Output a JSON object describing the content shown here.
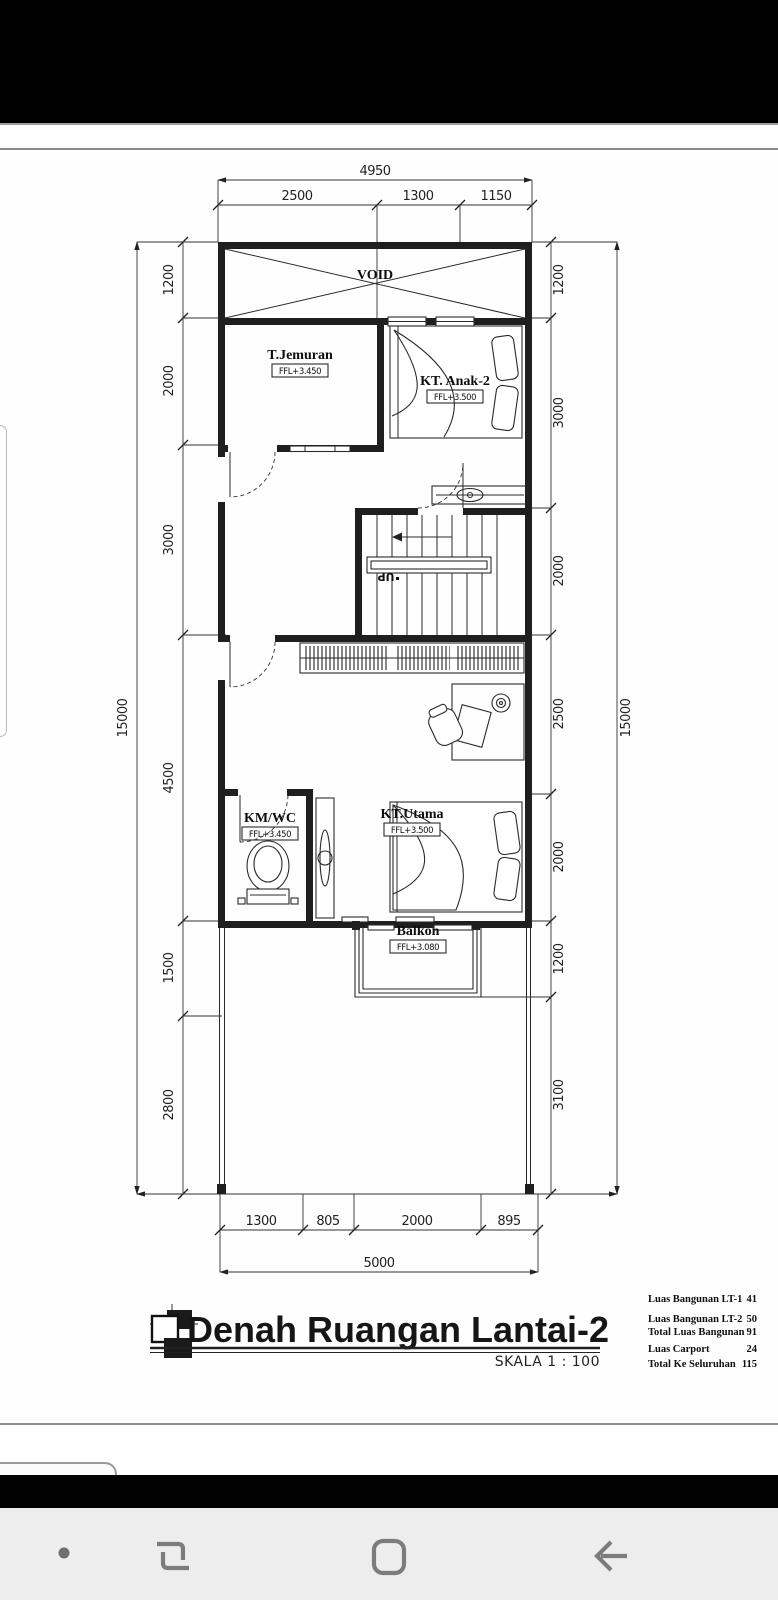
{
  "plan": {
    "title": "Denah Ruangan Lantai-2",
    "scale": "SKALA 1 : 100",
    "rooms": {
      "void": "VOID",
      "jemuran": {
        "name": "T.Jemuran",
        "ffl": "FFL+3.450"
      },
      "anak2": {
        "name": "KT. Anak-2",
        "ffl": "FFL+3.500"
      },
      "kmwc": {
        "name": "KM/WC",
        "ffl": "FFL+3.450"
      },
      "utama": {
        "name": "KT.Utama",
        "ffl": "FFL+3.500"
      },
      "balkon": {
        "name": "Balkon",
        "ffl": "FFL+3.080"
      },
      "stairs_direction": "UP"
    },
    "dims": {
      "top_total": "4950",
      "top": [
        "2500",
        "1300",
        "1150"
      ],
      "left_total": "15000",
      "left": [
        "1200",
        "2000",
        "3000",
        "4500",
        "1500",
        "2800"
      ],
      "right_total": "15000",
      "right": [
        "1200",
        "3000",
        "2000",
        "2500",
        "2000",
        "1200",
        "3100"
      ],
      "bottom": [
        "1300",
        "805",
        "2000",
        "895"
      ],
      "bottom_total": "5000"
    },
    "areas": [
      {
        "label": "Luas Bangunan LT-1",
        "value": "41"
      },
      {
        "label": "Luas Bangunan LT-2",
        "value": "50"
      },
      {
        "label": "Total Luas Bangunan",
        "value": "91"
      },
      {
        "label": "Luas Carport",
        "value": "24"
      },
      {
        "label": "Total Ke Seluruhan",
        "value": "115"
      }
    ]
  },
  "colors": {
    "drawing_ink": "#1f1f1f",
    "status_bar": "#000000",
    "nav_bar_bg": "#ededed",
    "nav_icon": "#7c7c7c"
  }
}
